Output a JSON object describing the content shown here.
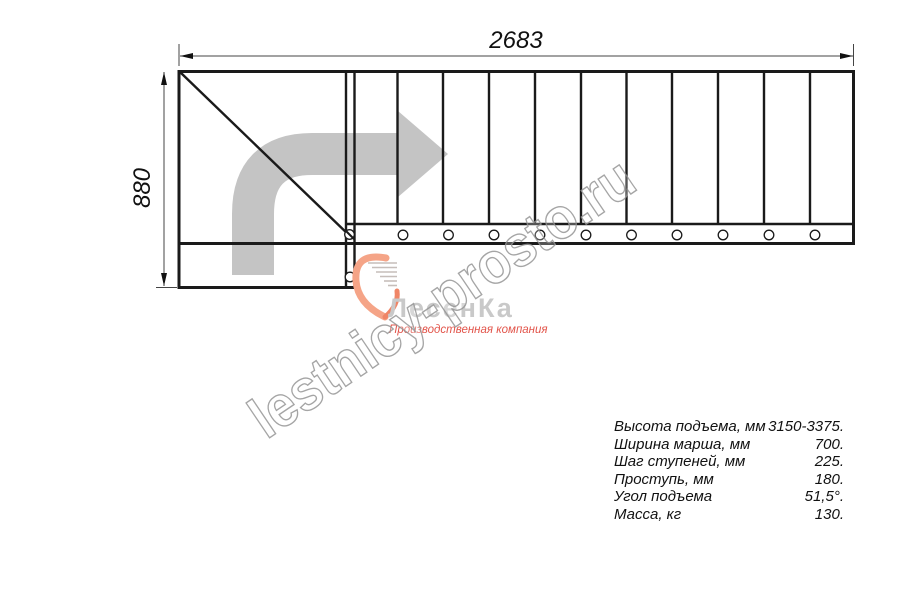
{
  "drawing": {
    "title_dimension_width": "2683",
    "title_dimension_height": "880",
    "steps_count": 11,
    "line_color": "#1a1a1a",
    "arrow_color": "#c4c4c4"
  },
  "watermark": {
    "text": "lestnicy-prosto.ru",
    "color": "#969696"
  },
  "logo": {
    "name": "ЛесенКа",
    "tagline": "Производственная компания",
    "heart_color": "#f5a487",
    "heart_color_dark": "#ef8566",
    "name_color": "#c9c9c9",
    "tagline_color": "#e2544a"
  },
  "specs": {
    "rows": [
      {
        "label": "Высота подъема, мм",
        "value": "3150-3375."
      },
      {
        "label": "Ширина марша, мм",
        "value": "700."
      },
      {
        "label": "Шаг ступеней, мм",
        "value": "225."
      },
      {
        "label": "Проступь, мм",
        "value": "180."
      },
      {
        "label": "Угол подъема",
        "value": "51,5°."
      },
      {
        "label": "Масса, кг",
        "value": "130."
      }
    ]
  }
}
